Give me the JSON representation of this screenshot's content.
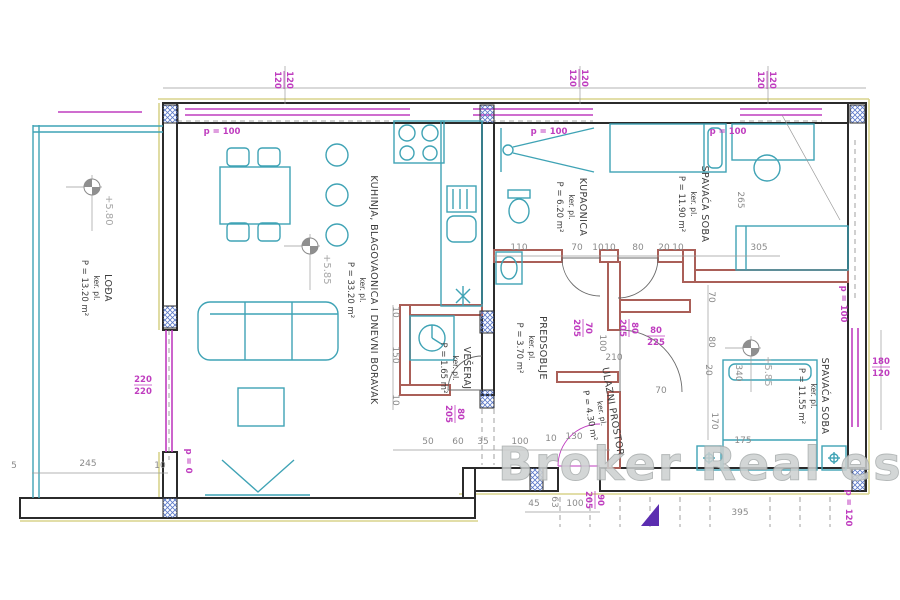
{
  "watermark": {
    "text": "Broker Real estate"
  },
  "colors": {
    "furniture_teal": "#3fa3b5",
    "opening_magenta": "#bf3dbf",
    "dimension_gray": "#8a8a8a",
    "wall_black": "#2b2b2b",
    "partition_red": "#aa5f58",
    "outer_outline_yellow": "#d8d48c",
    "pier_hatch_blue": "#5b79c9",
    "elevation_gray": "#a6a6a6"
  },
  "rooms": [
    {
      "title": "LOĐA",
      "sub": "ker. pl.",
      "area": "P = 13.20 m²",
      "x": 105,
      "y": 288,
      "r": 90
    },
    {
      "title": "KUHINJA, BLAGOVAONICA I DNEVNI BORAVAK",
      "sub": "ker. pl.",
      "area": "P = 33.20 m²",
      "x": 371,
      "y": 290,
      "r": 90
    },
    {
      "title": "KUPAONICA",
      "sub": "ker. pl.",
      "area": "P = 6.20 m²",
      "x": 580,
      "y": 207,
      "r": 90
    },
    {
      "title": "SPAVAĆA SOBA",
      "sub": "ker. pl.",
      "area": "P = 11.90 m²",
      "x": 702,
      "y": 204,
      "r": 90
    },
    {
      "title": "PREDSOBLJE",
      "sub": "ker. pl.",
      "area": "P = 3.70 m²",
      "x": 540,
      "y": 348,
      "r": 90
    },
    {
      "title": "VEŠERAJ",
      "sub": "ker. pl.",
      "area": "P = 1.65 m²",
      "x": 464,
      "y": 368,
      "r": 90
    },
    {
      "title": "ULAZNI PROSTOR",
      "sub": "ker. pl.",
      "area": "P = 4.30 m²",
      "x": 610,
      "y": 412,
      "r": 80
    },
    {
      "title": "SPAVAĆA SOBA",
      "sub": "ker. pl.",
      "area": "P = 11.55 m²",
      "x": 822,
      "y": 396,
      "r": 90
    }
  ],
  "elevation_markers": [
    {
      "label": "+5.80",
      "x": 92,
      "y": 187
    },
    {
      "label": "+5.85",
      "x": 310,
      "y": 246
    },
    {
      "label": "+5.85",
      "x": 751,
      "y": 348
    }
  ],
  "opening_labels": [
    {
      "t": "p = 100",
      "x": 222,
      "y": 134,
      "r": 0
    },
    {
      "t": "p = 100",
      "x": 549,
      "y": 134,
      "r": 0
    },
    {
      "t": "p = 100",
      "x": 728,
      "y": 134,
      "r": 0
    },
    {
      "t": "p = 0",
      "x": 186,
      "y": 461,
      "r": 90
    },
    {
      "t": "p = 100",
      "x": 841,
      "y": 304,
      "r": 90
    },
    {
      "t": "p = 120",
      "x": 846,
      "y": 508,
      "r": 90
    }
  ],
  "opening_fractions": [
    {
      "top": "120",
      "bot": "120",
      "x": 285,
      "y": 80,
      "r": 90
    },
    {
      "top": "120",
      "bot": "120",
      "x": 580,
      "y": 78,
      "r": 90
    },
    {
      "top": "120",
      "bot": "120",
      "x": 768,
      "y": 80,
      "r": 90
    },
    {
      "top": "220",
      "bot": "220",
      "x": 143,
      "y": 384,
      "r": 0
    },
    {
      "top": "180",
      "bot": "120",
      "x": 881,
      "y": 366,
      "r": 0
    },
    {
      "top": "70",
      "bot": "205",
      "x": 584,
      "y": 328,
      "r": 90
    },
    {
      "top": "80",
      "bot": "205",
      "x": 630,
      "y": 328,
      "r": 90
    },
    {
      "top": "80",
      "bot": "225",
      "x": 656,
      "y": 335,
      "r": 0
    },
    {
      "top": "80",
      "bot": "205",
      "x": 456,
      "y": 414,
      "r": 90
    },
    {
      "top": "90",
      "bot": "205",
      "x": 596,
      "y": 500,
      "r": 90
    }
  ],
  "dimensions": [
    {
      "t": "5",
      "x": 14,
      "y": 468
    },
    {
      "t": "245",
      "x": 88,
      "y": 466
    },
    {
      "t": "10",
      "x": 160,
      "y": 468
    },
    {
      "t": "110",
      "x": 519,
      "y": 250
    },
    {
      "t": "70",
      "x": 577,
      "y": 250
    },
    {
      "t": "10",
      "x": 598,
      "y": 250
    },
    {
      "t": "10",
      "x": 610,
      "y": 250
    },
    {
      "t": "80",
      "x": 638,
      "y": 250
    },
    {
      "t": "20",
      "x": 664,
      "y": 250
    },
    {
      "t": "10",
      "x": 678,
      "y": 250
    },
    {
      "t": "305",
      "x": 759,
      "y": 250
    },
    {
      "t": "265",
      "x": 738,
      "y": 200,
      "r": 90
    },
    {
      "t": "10",
      "x": 393,
      "y": 312,
      "r": 90
    },
    {
      "t": "150",
      "x": 393,
      "y": 355,
      "r": 90
    },
    {
      "t": "10",
      "x": 393,
      "y": 400,
      "r": 90
    },
    {
      "t": "50",
      "x": 428,
      "y": 444
    },
    {
      "t": "60",
      "x": 458,
      "y": 444
    },
    {
      "t": "35",
      "x": 483,
      "y": 444
    },
    {
      "t": "100",
      "x": 520,
      "y": 444
    },
    {
      "t": "10",
      "x": 551,
      "y": 441
    },
    {
      "t": "130",
      "x": 574,
      "y": 439
    },
    {
      "t": "100",
      "x": 600,
      "y": 343,
      "r": 90
    },
    {
      "t": "210",
      "x": 614,
      "y": 360
    },
    {
      "t": "70",
      "x": 661,
      "y": 393
    },
    {
      "t": "70",
      "x": 709,
      "y": 297,
      "r": 90
    },
    {
      "t": "80",
      "x": 709,
      "y": 342,
      "r": 90
    },
    {
      "t": "20",
      "x": 706,
      "y": 370,
      "r": 90
    },
    {
      "t": "170",
      "x": 712,
      "y": 421,
      "r": 90
    },
    {
      "t": "340",
      "x": 736,
      "y": 373,
      "r": 90
    },
    {
      "t": "175",
      "x": 743,
      "y": 443
    },
    {
      "t": "45",
      "x": 534,
      "y": 506
    },
    {
      "t": "63",
      "x": 552,
      "y": 502,
      "r": 90
    },
    {
      "t": "100",
      "x": 575,
      "y": 506
    },
    {
      "t": "395",
      "x": 740,
      "y": 515
    }
  ]
}
